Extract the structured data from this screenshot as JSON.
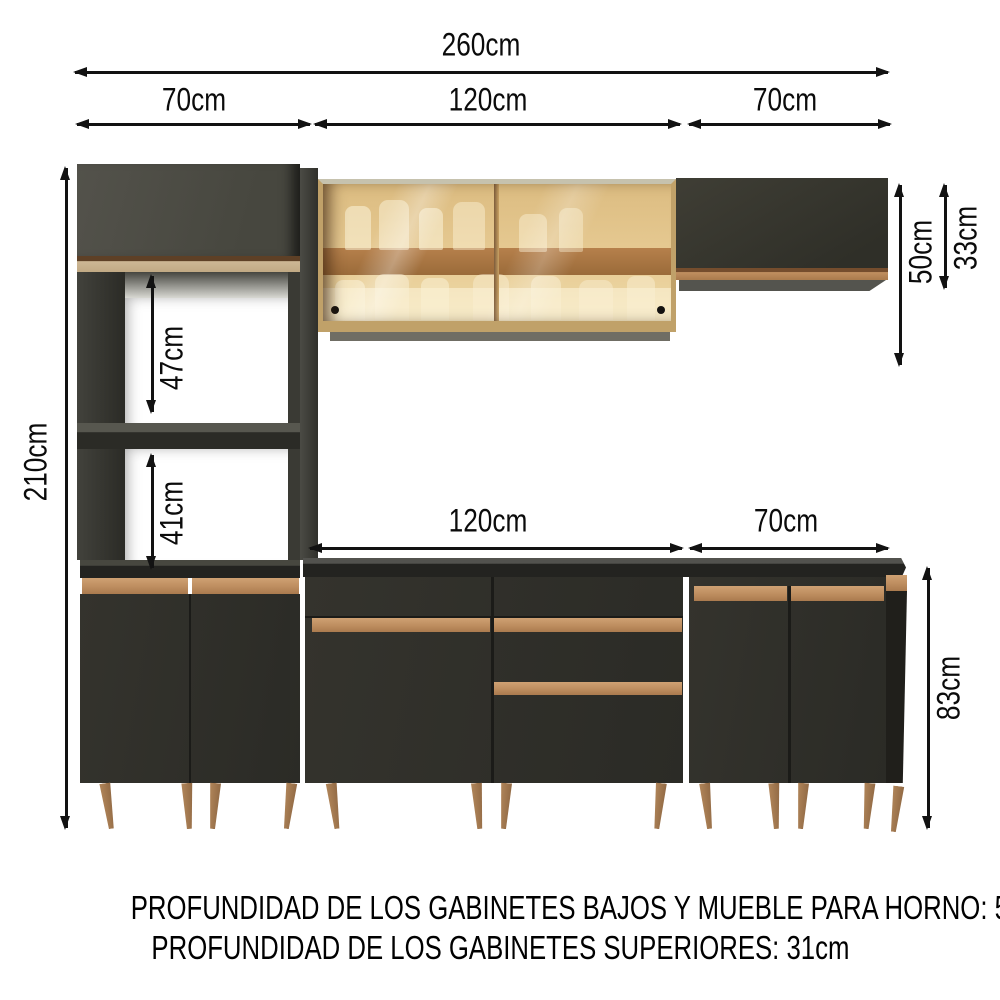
{
  "dimensions": {
    "total_width": "260cm",
    "top_left_width": "70cm",
    "top_center_width": "120cm",
    "top_right_width": "70cm",
    "total_height": "210cm",
    "upper_niche_height": "47cm",
    "lower_niche_height": "41cm",
    "wall_cabinet_drop": "50cm",
    "wall_cabinet_height": "33cm",
    "counter_center_width": "120cm",
    "counter_right_width": "70cm",
    "base_cabinet_height": "83cm"
  },
  "notes": {
    "line1": "PROFUNDIDAD DE LOS GABINETES BAJOS Y MUEBLE PARA HORNO: 52cm",
    "line2": "PROFUNDIDAD DE LOS GABINETES SUPERIORES: 31cm"
  },
  "colors": {
    "dimension_line": "#121212",
    "cabinet_dark": "#2e2e29",
    "cabinet_upper_gray": "#4b4b43",
    "handle_tan": "#c08f60",
    "trim_beige": "#cbb795",
    "wood_leg": "#a87c52",
    "glass_amber": "#e8c98e",
    "glass_frame": "#c9a263",
    "shelf_brown": "#a5713f",
    "countertop": "#232320"
  }
}
